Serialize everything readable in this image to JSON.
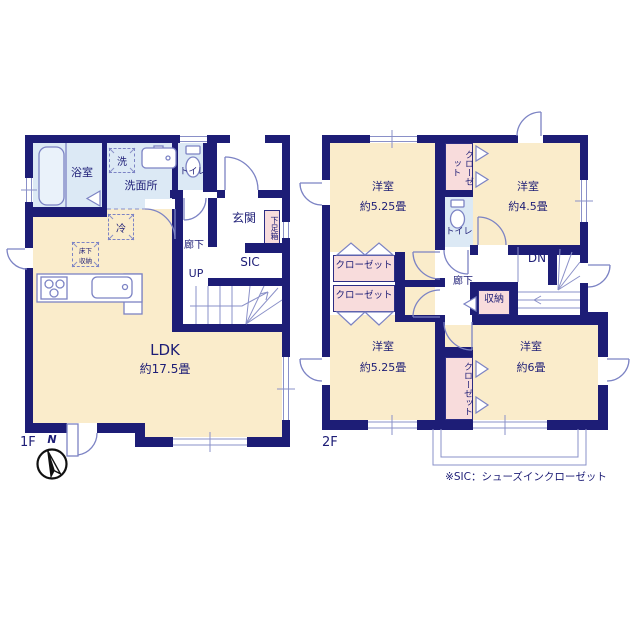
{
  "f1": {
    "floor_label": "1F",
    "bath": "浴室",
    "washer": "洗",
    "washroom": "洗面所",
    "toilet": "トイレ",
    "fridge": "冷",
    "underfloor": "床下収納",
    "entrance": "玄関",
    "shoe_box": "下足箱",
    "hallway": "廊下",
    "sic": "SIC",
    "up": "UP",
    "ldk": "LDK",
    "ldk_size": "約17.5畳"
  },
  "f2": {
    "floor_label": "2F",
    "room_nw": "洋室",
    "room_nw_size": "約5.25畳",
    "closet_n": "クローゼット",
    "toilet": "トイレ",
    "room_ne": "洋室",
    "room_ne_size": "約4.5畳",
    "closet_w1": "クローゼット",
    "closet_w2": "クローゼット",
    "hallway": "廊下",
    "dn": "DN",
    "storage": "収納",
    "room_sw": "洋室",
    "room_sw_size": "約5.25畳",
    "closet_s": "クローゼット",
    "room_se": "洋室",
    "room_se_size": "約6畳"
  },
  "compass": {
    "n": "N"
  },
  "footnote": "※SIC：シューズインクローゼット",
  "colors": {
    "wall": "#1d1d76",
    "room_beige": "#faeccb",
    "wet_blue": "#dce9f5",
    "closet_pink": "#f8dcdc",
    "line_blue": "#7c83c4",
    "text_navy": "#1d1d76"
  }
}
